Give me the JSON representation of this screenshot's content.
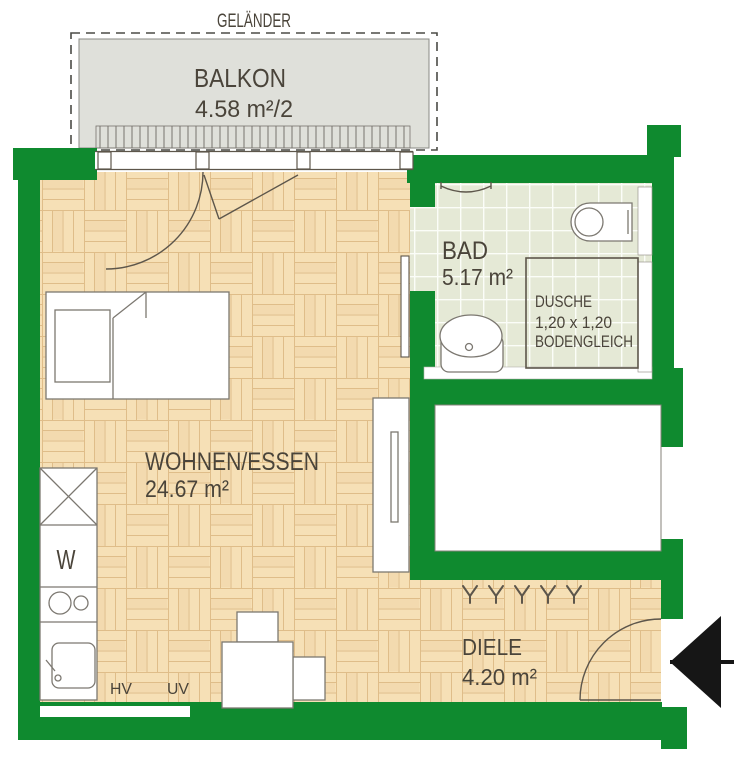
{
  "rooms": {
    "balcony": {
      "name": "BALKON",
      "area": "4.58 m²/2"
    },
    "living": {
      "name": "WOHNEN/ESSEN",
      "area": "24.67 m²"
    },
    "bath": {
      "name": "BAD",
      "area": "5.17 m²"
    },
    "hall": {
      "name": "DIELE",
      "area": "4.20 m²"
    }
  },
  "shower": {
    "title": "DUSCHE",
    "size": "1,20 x 1,20",
    "note": "BODENGLEICH"
  },
  "annotations": {
    "railing": "GELÄNDER",
    "washer": "W",
    "hv": "HV",
    "uv": "UV"
  },
  "colors": {
    "wall": "#0f8a2f",
    "parquet_base": "#f6e0b6",
    "parquet_line": "#d6ae76",
    "parquet_streak": "#edd2a4",
    "tile_base": "#e5e9d6",
    "tile_line": "#fbfdf8",
    "balcony": "#dfe0da",
    "text": "#4a443a",
    "line": "#5d564b",
    "furniture": "#7c7871",
    "arrow": "#161616"
  }
}
